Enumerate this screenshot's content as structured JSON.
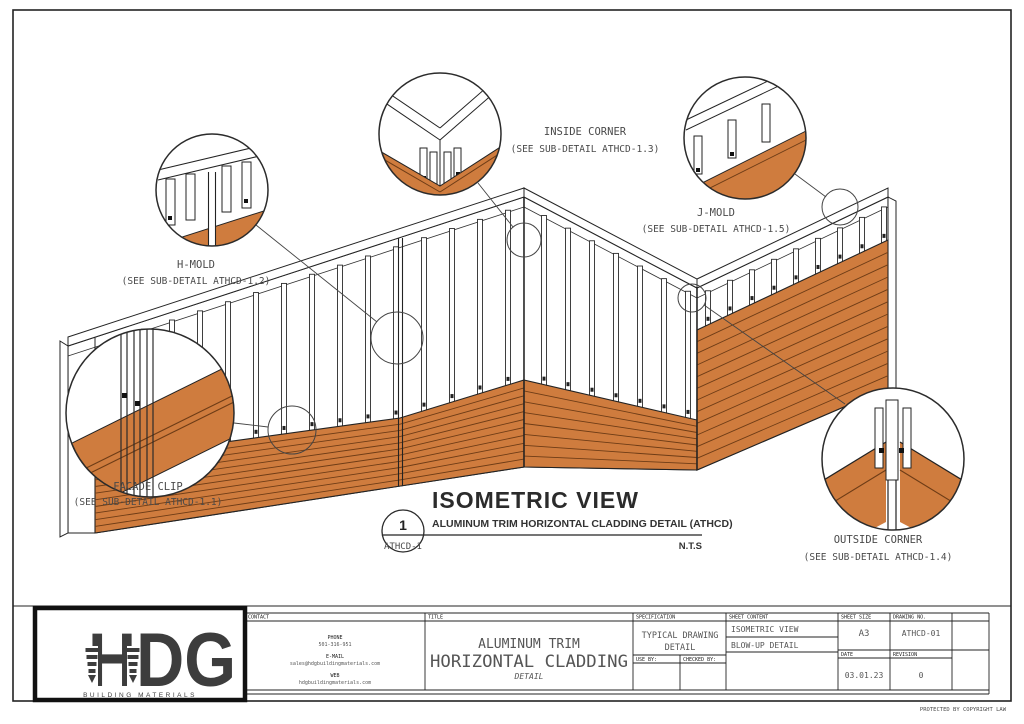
{
  "page": {
    "protected_note": "PROTECTED BY COPYRIGHT LAW"
  },
  "drawing": {
    "title": "ISOMETRIC VIEW",
    "subtitle": "ALUMINUM TRIM HORIZONTAL CLADDING DETAIL (ATHCD)",
    "scale": "N.T.S",
    "callout_number": "1",
    "callout_ref": "ATHCD-1",
    "labels": {
      "facade_clip": {
        "line1": "FACADE CLIP",
        "line2": "(SEE SUB-DETAIL ATHCD-1.1)"
      },
      "h_mold": {
        "line1": "H-MOLD",
        "line2": "(SEE SUB-DETAIL ATHCD-1.2)"
      },
      "inside_corner": {
        "line1": "INSIDE CORNER",
        "line2": "(SEE SUB-DETAIL ATHCD-1.3)"
      },
      "outside_corner": {
        "line1": "OUTSIDE CORNER",
        "line2": "(SEE SUB-DETAIL ATHCD-1.4)"
      },
      "j_mold": {
        "line1": "J-MOLD",
        "line2": "(SEE SUB-DETAIL ATHCD-1.5)"
      }
    }
  },
  "title_block": {
    "logo": {
      "text": "HDG",
      "tagline": "BUILDING MATERIALS"
    },
    "contact": {
      "header": "CONTACT",
      "phone_label": "PHONE",
      "phone": "501-316-951",
      "email_label": "E-MAIL",
      "email": "sales@hdgbuildingmaterials.com",
      "web_label": "WEB",
      "web": "hdgbuildingmaterials.com"
    },
    "title": {
      "header": "TITLE",
      "line1": "ALUMINUM TRIM",
      "line2": "HORIZONTAL CLADDING",
      "line3": "DETAIL"
    },
    "specification": {
      "header": "SPECIFICATION",
      "value1": "TYPICAL DRAWING",
      "value2": "DETAIL",
      "use_by_label": "USE BY:",
      "checked_by_label": "CHECKED BY:"
    },
    "sheet_content": {
      "header": "SHEET CONTENT",
      "row1": "ISOMETRIC VIEW",
      "row2": "BLOW-UP DETAIL"
    },
    "sheet_size": {
      "header": "SHEET SIZE",
      "value": "A3"
    },
    "drawing_no": {
      "header": "DRAWING NO.",
      "value": "ATHCD-01"
    },
    "date": {
      "header": "DATE",
      "value": "03.01.23"
    },
    "revision": {
      "header": "REVISION",
      "value": "0"
    }
  },
  "colors": {
    "cladding": "#cf7c3e",
    "board_line": "#6e3c16",
    "outline": "#232323",
    "label": "#4a4a4a"
  }
}
